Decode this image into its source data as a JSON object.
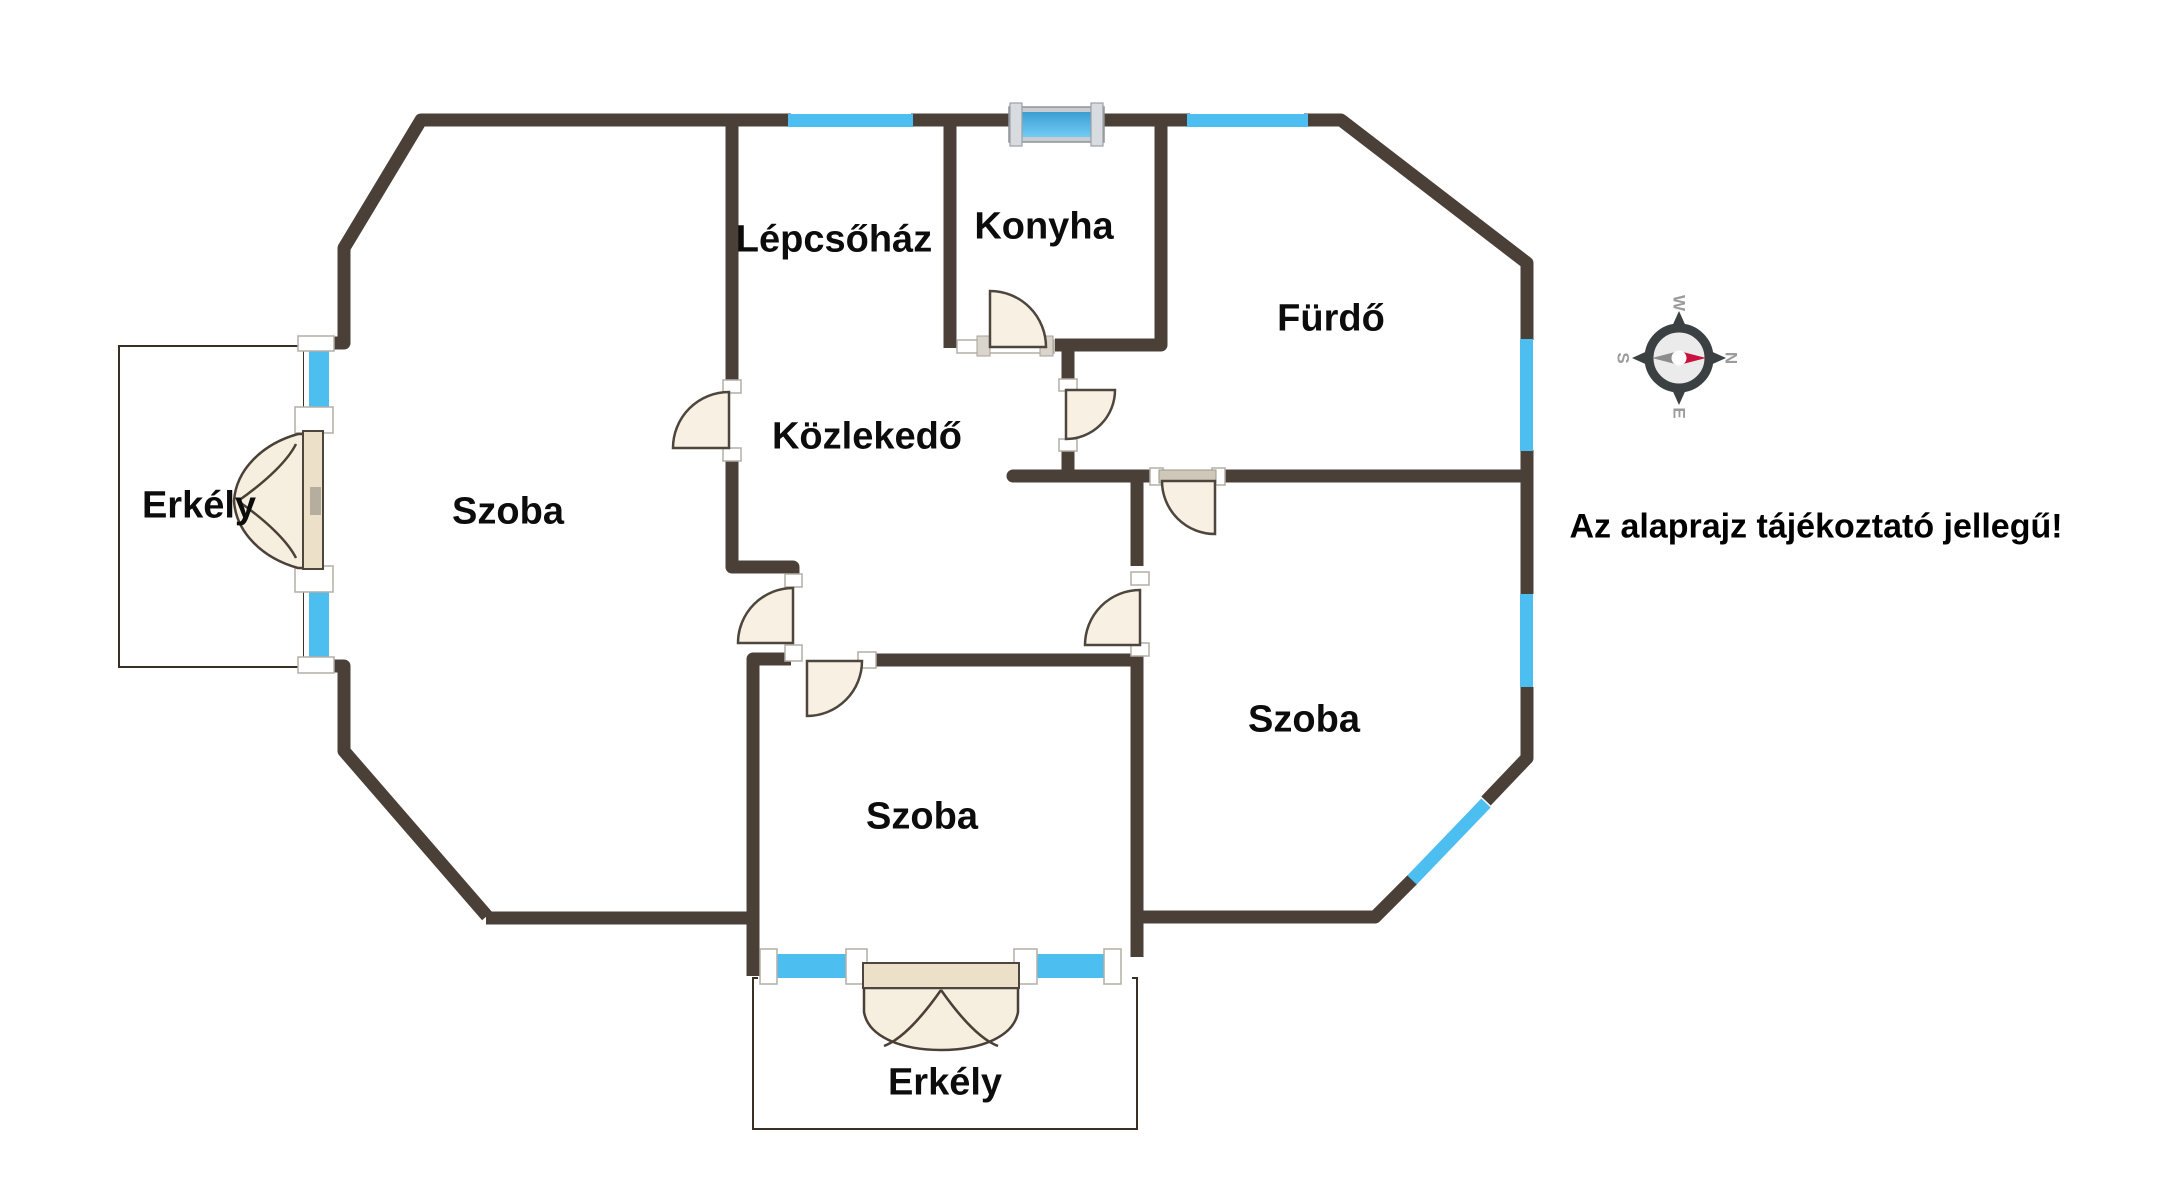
{
  "disclaimer": "Az alaprajz tájékoztató jellegű!",
  "rooms": {
    "lepcsohaz": "Lépcsőház",
    "konyha": "Konyha",
    "furdo": "Fürdő",
    "kozlekedo": "Közlekedő",
    "szoba_left": "Szoba",
    "szoba_right": "Szoba",
    "szoba_bottom": "Szoba",
    "erkely_left": "Erkély",
    "erkely_bottom": "Erkély"
  },
  "compass": {
    "north": "N",
    "east": "E",
    "south": "S",
    "west": "W"
  },
  "colors": {
    "wall": "#4b4038",
    "window": "#4dbef0",
    "window_frame_gray": "#c9ccd0",
    "door_fill": "#f8f0e3",
    "balcony_door_fill": "#f6efdf",
    "balcony_door_panel": "#ece0c8",
    "tile": "#d3a055",
    "grout": "#8a6030",
    "compass_ring": "#3b4043",
    "needle_north": "#c9133e",
    "needle_south": "#8c8c8c",
    "label_text": "#0c0c0c"
  }
}
